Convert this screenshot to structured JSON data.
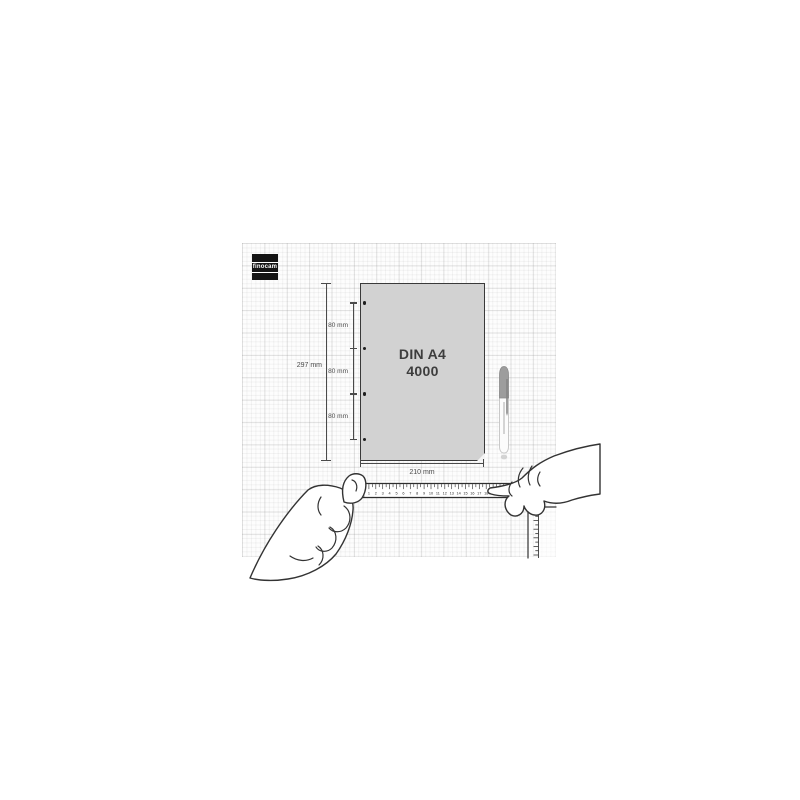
{
  "brand": {
    "logo_text": "finocam"
  },
  "sheet": {
    "title_line1": "DIN A4",
    "title_line2": "4000",
    "holes_count": 4
  },
  "dims": {
    "height": "297 mm",
    "width": "210 mm",
    "gaps": [
      "80 mm",
      "80 mm",
      "80 mm"
    ]
  },
  "ruler": {
    "unit": "cm",
    "numbers": [
      "1",
      "2",
      "3",
      "4",
      "5",
      "6",
      "7",
      "8",
      "9",
      "10",
      "11",
      "12",
      "13",
      "14",
      "15",
      "16",
      "17",
      "18",
      "19",
      "20",
      "21"
    ]
  },
  "colors": {
    "line": "#4a4a4a",
    "sheet_fill": "#d2d2d2",
    "logo_bg": "#141414",
    "pen_cap": "#9d9d9d"
  }
}
